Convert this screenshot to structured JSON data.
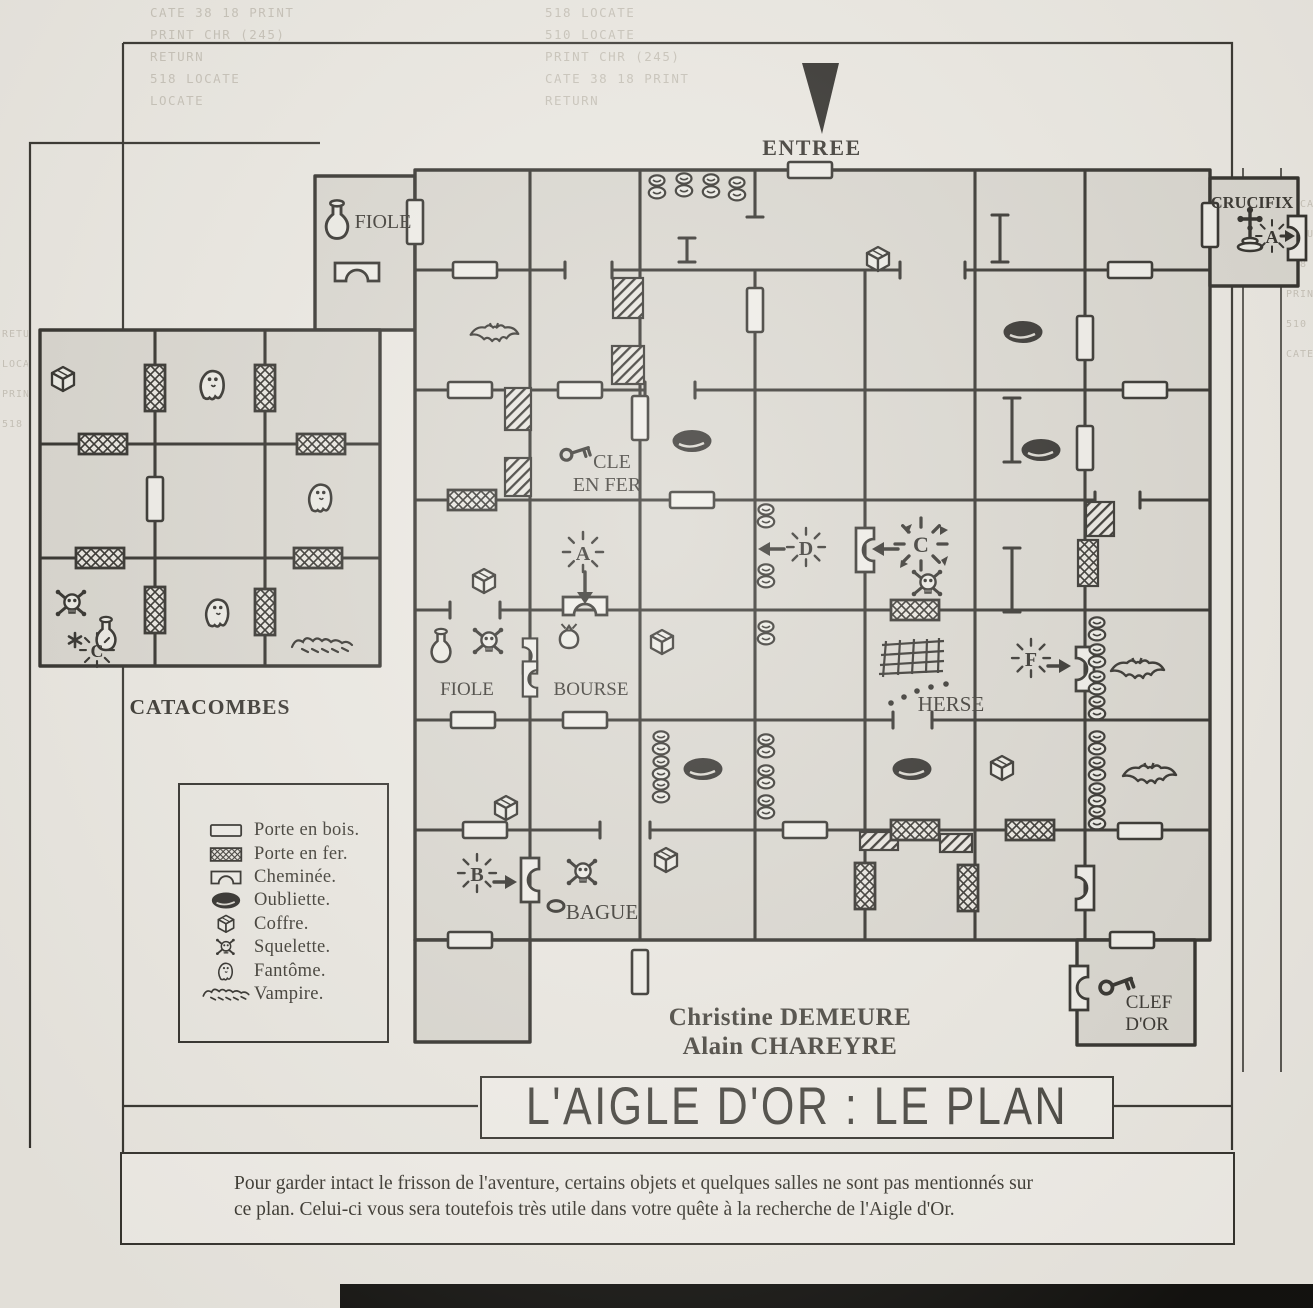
{
  "colors": {
    "paper": "#ebe8e1",
    "ink": "#2e2c27",
    "room_fill": "#d9d6ce"
  },
  "page": {
    "title": "L'AIGLE D'OR : LE PLAN",
    "credits": [
      "Christine DEMEURE",
      "Alain CHAREYRE"
    ],
    "note": {
      "line1": "Pour garder intact le frisson de l'aventure, certains objets et quelques salles ne sont pas mentionnés sur",
      "line2": "ce plan. Celui-ci vous sera toutefois très utile dans votre quête à la recherche de l'Aigle d'Or."
    }
  },
  "map": {
    "entrance": "ENTREE",
    "labels": {
      "crucifix": "CRUCIFIX",
      "fiole_top": "FIOLE",
      "cle_line1": "CLE",
      "cle_line2": "EN FER",
      "fiole": "FIOLE",
      "bourse": "BOURSE",
      "herse": "HERSE",
      "bague": "BAGUE",
      "clef_line1": "CLEF",
      "clef_line2": "D'OR"
    },
    "markers": {
      "a_crucifix": "A",
      "a": "A",
      "b": "B",
      "c": "C",
      "d": "D",
      "f": "F"
    }
  },
  "catacombes": {
    "label": "CATACOMBES",
    "marker_c": "C"
  },
  "legend": {
    "items": [
      {
        "icon": "wood-door-icon",
        "label": "Porte en bois."
      },
      {
        "icon": "iron-door-icon",
        "label": "Porte en fer."
      },
      {
        "icon": "fireplace-icon",
        "label": "Cheminée."
      },
      {
        "icon": "oubliette-icon",
        "label": "Oubliette."
      },
      {
        "icon": "chest-icon",
        "label": "Coffre."
      },
      {
        "icon": "skeleton-icon",
        "label": "Squelette."
      },
      {
        "icon": "ghost-icon",
        "label": "Fantôme."
      },
      {
        "icon": "vampire-icon",
        "label": "Vampire."
      }
    ]
  },
  "bleed": [
    "518 LOCATE",
    "PRINT CHR (245)",
    "CATE 38 18 PRINT",
    "RETURN",
    "510 LOCATE",
    "LOCATE"
  ]
}
